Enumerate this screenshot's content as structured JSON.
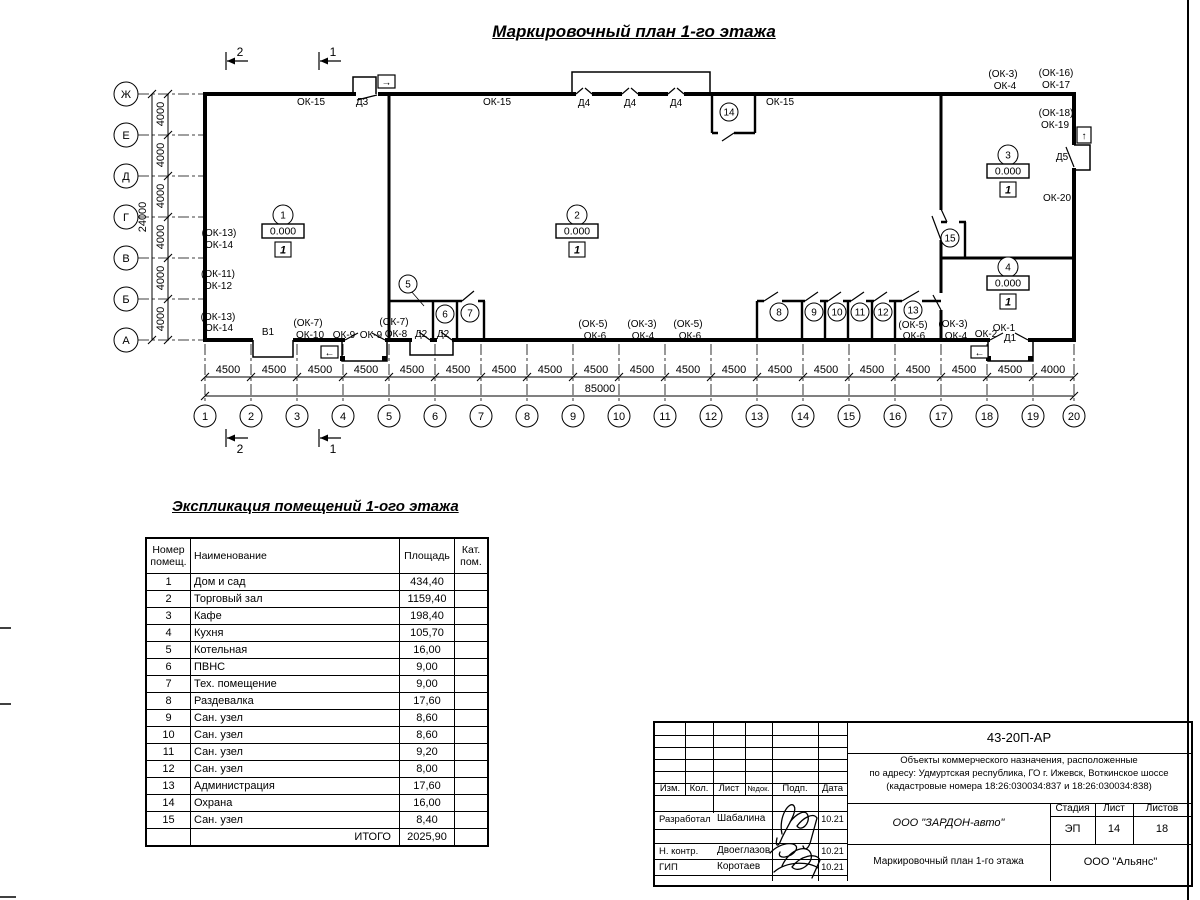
{
  "sheet": {
    "title": "Маркировочный план 1-го этажа"
  },
  "plan": {
    "row_axes": [
      {
        "label": "Ж",
        "y": 94
      },
      {
        "label": "Е",
        "y": 135
      },
      {
        "label": "Д",
        "y": 176
      },
      {
        "label": "Г",
        "y": 217
      },
      {
        "label": "В",
        "y": 258
      },
      {
        "label": "Б",
        "y": 299
      },
      {
        "label": "А",
        "y": 340
      }
    ],
    "col_axes": [
      {
        "label": "1",
        "x": 205
      },
      {
        "label": "2",
        "x": 251
      },
      {
        "label": "3",
        "x": 297
      },
      {
        "label": "4",
        "x": 343
      },
      {
        "label": "5",
        "x": 389
      },
      {
        "label": "6",
        "x": 435
      },
      {
        "label": "7",
        "x": 481
      },
      {
        "label": "8",
        "x": 527
      },
      {
        "label": "9",
        "x": 573
      },
      {
        "label": "10",
        "x": 619
      },
      {
        "label": "11",
        "x": 665
      },
      {
        "label": "12",
        "x": 711
      },
      {
        "label": "13",
        "x": 757
      },
      {
        "label": "14",
        "x": 803
      },
      {
        "label": "15",
        "x": 849
      },
      {
        "label": "16",
        "x": 895
      },
      {
        "label": "17",
        "x": 941
      },
      {
        "label": "18",
        "x": 987
      },
      {
        "label": "19",
        "x": 1033
      },
      {
        "label": "20",
        "x": 1074
      }
    ],
    "v_dim_labels": [
      {
        "t": "4000",
        "y": 114
      },
      {
        "t": "4000",
        "y": 155
      },
      {
        "t": "4000",
        "y": 196
      },
      {
        "t": "4000",
        "y": 237
      },
      {
        "t": "4000",
        "y": 278
      },
      {
        "t": "4000",
        "y": 319
      }
    ],
    "v_total": {
      "t": "24000",
      "y": 217
    },
    "h_dim_labels": [
      {
        "t": "4500",
        "x": 228
      },
      {
        "t": "4500",
        "x": 274
      },
      {
        "t": "4500",
        "x": 320
      },
      {
        "t": "4500",
        "x": 366
      },
      {
        "t": "4500",
        "x": 412
      },
      {
        "t": "4500",
        "x": 458
      },
      {
        "t": "4500",
        "x": 504
      },
      {
        "t": "4500",
        "x": 550
      },
      {
        "t": "4500",
        "x": 596
      },
      {
        "t": "4500",
        "x": 642
      },
      {
        "t": "4500",
        "x": 688
      },
      {
        "t": "4500",
        "x": 734
      },
      {
        "t": "4500",
        "x": 780
      },
      {
        "t": "4500",
        "x": 826
      },
      {
        "t": "4500",
        "x": 872
      },
      {
        "t": "4500",
        "x": 918
      },
      {
        "t": "4500",
        "x": 964
      },
      {
        "t": "4500",
        "x": 1010
      },
      {
        "t": "4000",
        "x": 1053
      }
    ],
    "h_total": {
      "t": "85000",
      "x": 600
    },
    "section_marks": [
      {
        "n": "2",
        "x": 226,
        "side": "top"
      },
      {
        "n": "1",
        "x": 319,
        "side": "top"
      },
      {
        "n": "2",
        "x": 226,
        "side": "bottom"
      },
      {
        "n": "1",
        "x": 319,
        "side": "bottom"
      }
    ],
    "wall_labels": [
      {
        "t": "ОК-15",
        "x": 311,
        "y": 105
      },
      {
        "t": "Д3",
        "x": 362,
        "y": 105
      },
      {
        "t": "ОК-15",
        "x": 497,
        "y": 105
      },
      {
        "t": "Д4",
        "x": 584,
        "y": 106
      },
      {
        "t": "Д4",
        "x": 630,
        "y": 106
      },
      {
        "t": "Д4",
        "x": 676,
        "y": 106
      },
      {
        "t": "ОК-15",
        "x": 780,
        "y": 105
      },
      {
        "t": "(ОК-3)",
        "x": 1003,
        "y": 77
      },
      {
        "t": "ОК-4",
        "x": 1005,
        "y": 89
      },
      {
        "t": "(ОК-16)",
        "x": 1056,
        "y": 76
      },
      {
        "t": "ОК-17",
        "x": 1056,
        "y": 88
      },
      {
        "t": "(ОК-18)",
        "x": 1056,
        "y": 116
      },
      {
        "t": "ОК-19",
        "x": 1055,
        "y": 128
      },
      {
        "t": "Д5",
        "x": 1062,
        "y": 160
      },
      {
        "t": "ОК-20",
        "x": 1057,
        "y": 201
      },
      {
        "t": "(ОК-13)",
        "x": 219,
        "y": 236
      },
      {
        "t": "ОК-14",
        "x": 219,
        "y": 248
      },
      {
        "t": "(ОК-11)",
        "x": 218,
        "y": 277
      },
      {
        "t": "ОК-12",
        "x": 218,
        "y": 289
      },
      {
        "t": "(ОК-13)",
        "x": 218,
        "y": 320
      },
      {
        "t": "ОК-14",
        "x": 219,
        "y": 331
      },
      {
        "t": "В1",
        "x": 268,
        "y": 335
      },
      {
        "t": "(ОК-7)",
        "x": 308,
        "y": 326
      },
      {
        "t": "ОК-10",
        "x": 310,
        "y": 338
      },
      {
        "t": "ОК-9",
        "x": 344,
        "y": 338
      },
      {
        "t": "ОК-9",
        "x": 371,
        "y": 338
      },
      {
        "t": "(ОК-7)",
        "x": 394,
        "y": 325
      },
      {
        "t": "ОК-8",
        "x": 396,
        "y": 337
      },
      {
        "t": "Д2",
        "x": 421,
        "y": 337
      },
      {
        "t": "Д2",
        "x": 443,
        "y": 337
      },
      {
        "t": "(ОК-5)",
        "x": 593,
        "y": 327
      },
      {
        "t": "ОК-6",
        "x": 595,
        "y": 339
      },
      {
        "t": "(ОК-3)",
        "x": 642,
        "y": 327
      },
      {
        "t": "ОК-4",
        "x": 643,
        "y": 339
      },
      {
        "t": "(ОК-5)",
        "x": 688,
        "y": 327
      },
      {
        "t": "ОК-6",
        "x": 690,
        "y": 339
      },
      {
        "t": "(ОК-5)",
        "x": 913,
        "y": 328
      },
      {
        "t": "ОК-6",
        "x": 914,
        "y": 339
      },
      {
        "t": "(ОК-3)",
        "x": 953,
        "y": 327
      },
      {
        "t": "ОК-4",
        "x": 956,
        "y": 339
      },
      {
        "t": "ОК-2",
        "x": 986,
        "y": 337
      },
      {
        "t": "ОК-1",
        "x": 1004,
        "y": 331
      },
      {
        "t": "Д1",
        "x": 1010,
        "y": 341
      }
    ],
    "room_markers": [
      {
        "n": "1",
        "elev": "0.000",
        "floor": "1",
        "x": 283,
        "y": 215
      },
      {
        "n": "2",
        "elev": "0.000",
        "floor": "1",
        "x": 577,
        "y": 215
      },
      {
        "n": "3",
        "elev": "0.000",
        "floor": "1",
        "x": 1008,
        "y": 155
      },
      {
        "n": "4",
        "elev": "0.000",
        "floor": "1",
        "x": 1008,
        "y": 267
      }
    ],
    "room_circles": [
      {
        "n": "5",
        "x": 408,
        "y": 284
      },
      {
        "n": "6",
        "x": 445,
        "y": 314
      },
      {
        "n": "7",
        "x": 470,
        "y": 313
      },
      {
        "n": "8",
        "x": 779,
        "y": 312
      },
      {
        "n": "9",
        "x": 814,
        "y": 312
      },
      {
        "n": "10",
        "x": 837,
        "y": 312
      },
      {
        "n": "11",
        "x": 860,
        "y": 312
      },
      {
        "n": "12",
        "x": 883,
        "y": 312
      },
      {
        "n": "13",
        "x": 913,
        "y": 310
      },
      {
        "n": "14",
        "x": 729,
        "y": 112
      },
      {
        "n": "15",
        "x": 950,
        "y": 238
      }
    ],
    "exit_arrows": [
      {
        "glyph": "→",
        "x": 378,
        "y": 75,
        "w": 17,
        "h": 13
      },
      {
        "glyph": "←",
        "x": 321,
        "y": 346,
        "w": 17,
        "h": 12
      },
      {
        "glyph": "←",
        "x": 971,
        "y": 346,
        "w": 17,
        "h": 12
      },
      {
        "glyph": "↑",
        "x": 1077,
        "y": 127,
        "w": 14,
        "h": 16
      }
    ]
  },
  "explication": {
    "title": "Экспликация помещений 1-ого этажа",
    "col_headers": {
      "num": "Номер помещ.",
      "name": "Наименование",
      "area": "Площадь",
      "cat": "Кат. пом."
    },
    "rows": [
      {
        "num": "1",
        "name": "Дом и сад",
        "area": "434,40",
        "cat": ""
      },
      {
        "num": "2",
        "name": "Торговый зал",
        "area": "1159,40",
        "cat": ""
      },
      {
        "num": "3",
        "name": "Кафе",
        "area": "198,40",
        "cat": ""
      },
      {
        "num": "4",
        "name": "Кухня",
        "area": "105,70",
        "cat": ""
      },
      {
        "num": "5",
        "name": "Котельная",
        "area": "16,00",
        "cat": ""
      },
      {
        "num": "6",
        "name": "ПВНС",
        "area": "9,00",
        "cat": ""
      },
      {
        "num": "7",
        "name": "Тех. помещение",
        "area": "9,00",
        "cat": ""
      },
      {
        "num": "8",
        "name": "Раздевалка",
        "area": "17,60",
        "cat": ""
      },
      {
        "num": "9",
        "name": "Сан. узел",
        "area": "8,60",
        "cat": ""
      },
      {
        "num": "10",
        "name": "Сан. узел",
        "area": "8,60",
        "cat": ""
      },
      {
        "num": "11",
        "name": "Сан. узел",
        "area": "9,20",
        "cat": ""
      },
      {
        "num": "12",
        "name": "Сан. узел",
        "area": "8,00",
        "cat": ""
      },
      {
        "num": "13",
        "name": "Администрация",
        "area": "17,60",
        "cat": ""
      },
      {
        "num": "14",
        "name": "Охрана",
        "area": "16,00",
        "cat": ""
      },
      {
        "num": "15",
        "name": "Сан. узел",
        "area": "8,40",
        "cat": ""
      }
    ],
    "total_label": "ИТОГО",
    "total_value": "2025,90"
  },
  "title_block": {
    "doc_number": "43-20П-АР",
    "description_lines": [
      "Объекты коммерческого назначения, расположенные",
      "по адресу: Удмуртская республика, ГО г. Ижевск, Воткинское шоссе",
      "(кадастровые номера 18:26:030034:837 и 18:26:030034:838)"
    ],
    "header_cols": [
      "Изм.",
      "Кол.",
      "Лист",
      "№док.",
      "Подп.",
      "Дата"
    ],
    "roles": [
      {
        "role": "Разработал",
        "name": "Шабалина",
        "date": "10.21"
      },
      {
        "role": "Н. контр.",
        "name": "Двоеглазов",
        "date": "10.21"
      },
      {
        "role": "ГИП",
        "name": "Коротаев",
        "date": "10.21"
      }
    ],
    "company": "ООО \"ЗАРДОН-авто\"",
    "stage_label": "Стадия",
    "sheet_label": "Лист",
    "sheets_label": "Листов",
    "stage": "ЭП",
    "sheet": "14",
    "sheets": "18",
    "drawing_title": "Маркировочный план 1-го этажа",
    "contractor": "ООО \"Альянс\""
  }
}
